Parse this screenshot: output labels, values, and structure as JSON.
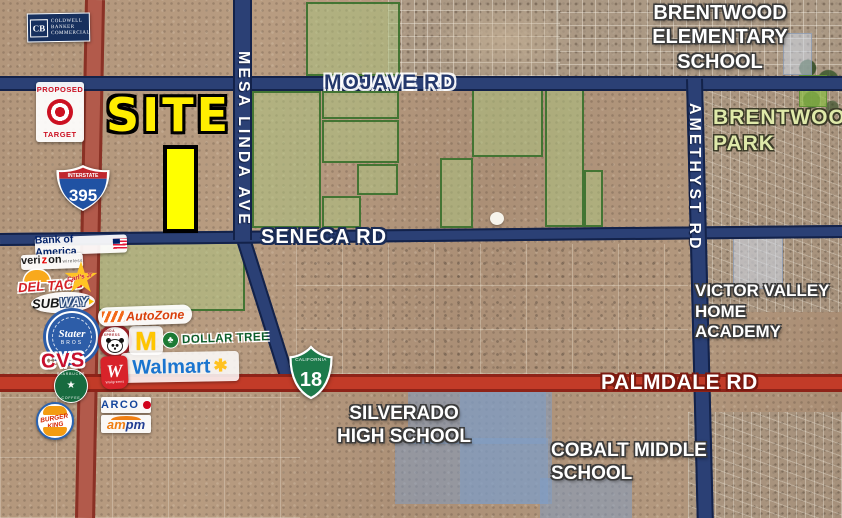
{
  "site": {
    "label": "SITE"
  },
  "roads": {
    "mojave": "MOJAVE RD",
    "seneca": "SENECA RD",
    "palmdale": "PALMDALE RD",
    "mesa_linda": "MESA LINDA AVE",
    "amethyst": "AMETHYST RD"
  },
  "highways": {
    "i395": {
      "banner": "INTERSTATE",
      "number": "395"
    },
    "ca18": {
      "state": "CALIFORNIA",
      "number": "18"
    }
  },
  "places": {
    "brentwood_elementary": {
      "lines": [
        "BRENTWOOD",
        "ELEMENTARY",
        "SCHOOL"
      ]
    },
    "brentwood_park": {
      "lines": [
        "BRENTWOOD",
        "PARK"
      ]
    },
    "victor_valley": {
      "lines": [
        "VICTOR VALLEY",
        "HOME",
        "ACADEMY"
      ]
    },
    "silverado": {
      "lines": [
        "SILVERADO",
        "HIGH SCHOOL"
      ]
    },
    "cobalt": {
      "lines": [
        "COBALT MIDDLE",
        "SCHOOL"
      ]
    }
  },
  "logos": {
    "coldwell": {
      "mark": "CB",
      "lines": [
        "COLDWELL",
        "BANKER",
        "COMMERCIAL"
      ]
    },
    "target": {
      "proposed": "PROPOSED",
      "name": "TARGET"
    },
    "bank_of_america": {
      "name": "Bank of America"
    },
    "verizon": {
      "name": "veri",
      "z": "z",
      "end": "on",
      "sub": "wireless"
    },
    "del_taco": {
      "name": "DEL TACO"
    },
    "carls_jr": {
      "name": "Carl's Jr"
    },
    "subway": {
      "part1": "SUB",
      "part2": "WAY"
    },
    "stater_bros": {
      "name": "Stater",
      "sub": "BROS"
    },
    "cvs": {
      "name": "CVS"
    },
    "starbucks": {
      "top": "STARBUCKS",
      "bottom": "COFFEE"
    },
    "burger_king": {
      "line1": "BURGER",
      "line2": "KING"
    },
    "panda_express": {
      "ring": "PANDA EXPRESS"
    },
    "mcdonalds": {
      "mark": "M"
    },
    "dollar_tree": {
      "name": "DOLLAR TREE"
    },
    "walmart": {
      "name": "Walmart",
      "spark": "✱"
    },
    "walgreens": {
      "mark": "W",
      "name": "Walgreens"
    },
    "autozone": {
      "name": "AutoZone"
    },
    "arco": {
      "name": "ARCO"
    },
    "ampm": {
      "part1": "am",
      "part2": "pm"
    }
  },
  "colors": {
    "road_navy": "#2b4075",
    "road_palmdale_red": "#c23b28",
    "road_395_red": "#b25a4b",
    "parcel_green": "#acc680",
    "site_yellow": "#ffff00",
    "school_highlight_blue": "#7e9ec8",
    "park_label_green": "#dfe9a9"
  }
}
